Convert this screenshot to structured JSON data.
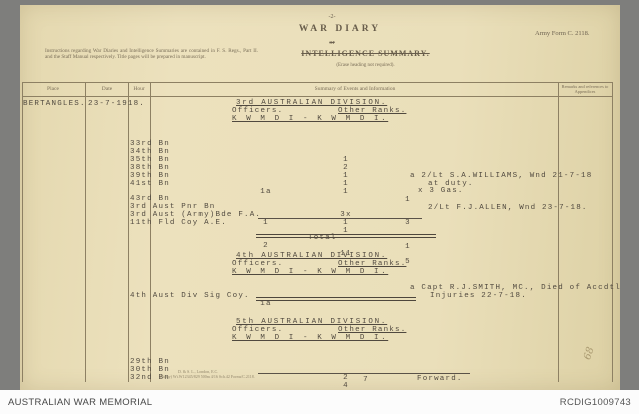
{
  "viewer": {
    "source_label": "AUSTRALIAN WAR MEMORIAL",
    "reference": "RCDIG1009743"
  },
  "form": {
    "page_number": "-2-",
    "title": "WAR DIARY",
    "or_text": "or",
    "subtitle": "INTELLIGENCE SUMMARY.",
    "subtitle_note": "(Erase heading not required).",
    "form_number": "Army Form C. 2118.",
    "instructions": "Instructions regarding War Diaries and Intelligence Summaries are contained in F. S. Regs., Part II. and the Staff Manual respectively. Title pages will be prepared in manuscript.",
    "columns": {
      "place": "Place",
      "date": "Date",
      "hour": "Hour",
      "summary": "Summary of Events and Information",
      "remarks": "Remarks and references to Appendices"
    },
    "imprint_line1": "D. & S. L., London, E.C.",
    "imprint_line2": "(Army) Wt.W12345/829 500m 4/16 Sch.42 Forms/C.2118."
  },
  "entry": {
    "place": "BERTANGLES.",
    "date": "23-7-1918."
  },
  "sections": [
    {
      "title": "3rd AUSTRALIAN DIVISION.",
      "officers_label": "Officers.",
      "other_ranks_label": "Other Ranks.",
      "casualty_key": "K W M D I - K W M D I.",
      "rows": [
        {
          "label": "33rd Bn",
          "off": "",
          "ork": "1",
          "orw": ""
        },
        {
          "label": "34th Bn",
          "off": "",
          "ork": "2",
          "orw": ""
        },
        {
          "label": "35th Bn",
          "off": "",
          "ork": "1",
          "orw": ""
        },
        {
          "label": "38th Bn",
          "off": "",
          "ork": "1",
          "orw": ""
        },
        {
          "label": "39th Bn",
          "off": "",
          "ork": "1",
          "orw": "1"
        },
        {
          "label": "41st Bn",
          "off": "1a",
          "ork": "",
          "orw": ""
        },
        {
          "label": "43rd Bn",
          "off": "",
          "ork": "3x",
          "orw": "3"
        },
        {
          "label": "3rd Aust Pnr Bn",
          "off": "",
          "ork": "1",
          "orw": ""
        },
        {
          "label": "3rd Aust (Army)Bde F.A.",
          "off": "1",
          "ork": "1",
          "orw": ""
        },
        {
          "label": "11th Fld Coy A.E.",
          "off": "",
          "ork": "",
          "orw": "1"
        }
      ],
      "total_label": "Total",
      "total_off": "2",
      "total_ork": "11",
      "total_orw": "5",
      "remarks": [
        {
          "l1": "a 2/Lt S.A.WILLIAMS, Wnd 21-7-18",
          "l2": "at duty."
        },
        {
          "l1": "x 3 Gas.",
          "l2": ""
        },
        {
          "l1": "2/Lt F.J.ALLEN, Wnd 23-7-18.",
          "l2": ""
        }
      ]
    },
    {
      "title": "4th AUSTRALIAN DIVISION.",
      "officers_label": "Officers.",
      "other_ranks_label": "Other Ranks.",
      "casualty_key": "K W M D I - K W M D I.",
      "rows": [
        {
          "label": "4th Aust Div Sig Coy.",
          "off": "1a",
          "ork": "",
          "orw": ""
        }
      ],
      "remarks": [
        {
          "l1": "a Capt R.J.SMITH, MC., Died of Accdtl",
          "l2": "Injuries 22-7-18."
        }
      ]
    },
    {
      "title": "5th AUSTRALIAN DIVISION.",
      "officers_label": "Officers.",
      "other_ranks_label": "Other Ranks.",
      "casualty_key": "K W M D I - K W M D I.",
      "rows": [
        {
          "label": "29th Bn",
          "off": "",
          "ork": "2",
          "orw": ""
        },
        {
          "label": "30th Bn",
          "off": "",
          "ork": "4",
          "orw": ""
        },
        {
          "label": "32nd Bn",
          "off": "",
          "ork": "1",
          "orw": ""
        }
      ],
      "forward_value": "7",
      "forward_label": "Forward."
    }
  ],
  "annotations": {
    "handwritten": "68"
  }
}
